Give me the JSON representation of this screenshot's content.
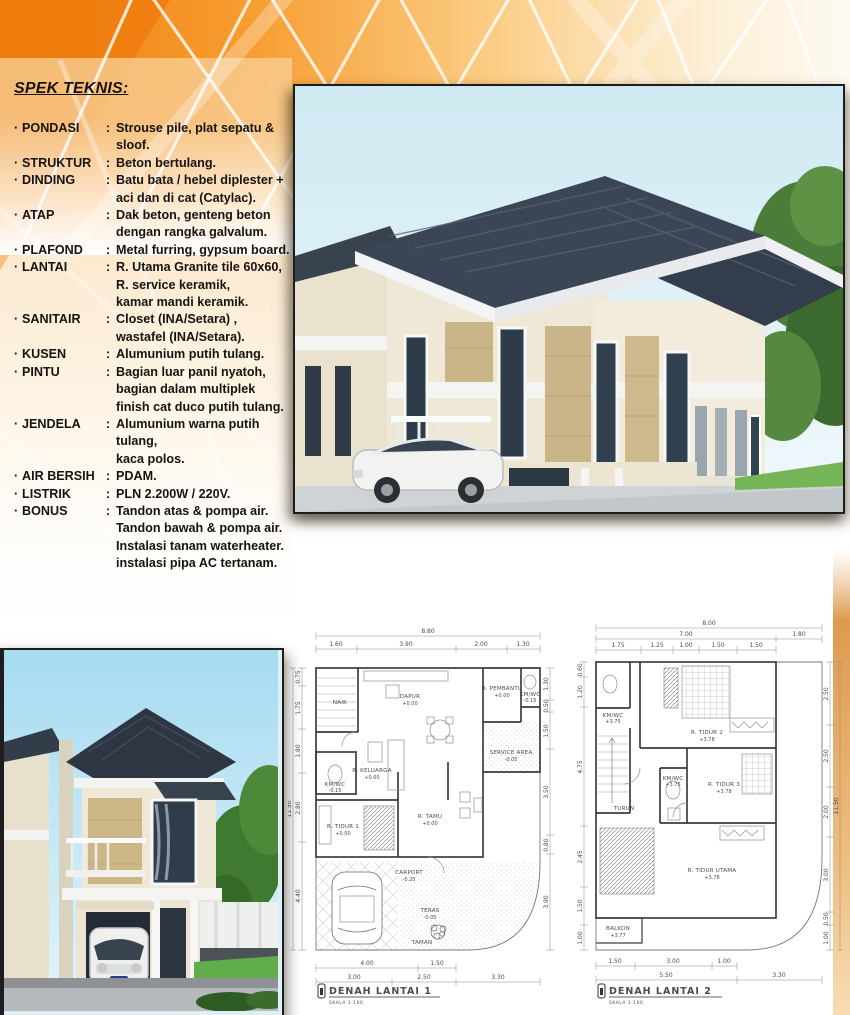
{
  "spec": {
    "title": "SPEK TEKNIS:",
    "bullet": "·",
    "colon": ":",
    "items": [
      {
        "label": "PONDASI",
        "value": "Strouse pile, plat sepatu &\nsloof."
      },
      {
        "label": "STRUKTUR",
        "value": "Beton bertulang."
      },
      {
        "label": "DINDING",
        "value": "Batu bata / hebel diplester +\naci dan di cat (Catylac)."
      },
      {
        "label": "ATAP",
        "value": "Dak beton, genteng beton\ndengan rangka galvalum."
      },
      {
        "label": "PLAFOND",
        "value": "Metal furring, gypsum board."
      },
      {
        "label": "LANTAI",
        "value": "R. Utama Granite tile 60x60,\nR. service keramik,\nkamar mandi keramik."
      },
      {
        "label": "SANITAIR",
        "value": "Closet (INA/Setara) ,\nwastafel (INA/Setara)."
      },
      {
        "label": "KUSEN",
        "value": "Alumunium putih tulang."
      },
      {
        "label": "PINTU",
        "value": "Bagian luar panil nyatoh,\nbagian dalam multiplek\nfinish cat duco putih tulang."
      },
      {
        "label": "JENDELA",
        "value": "Alumunium warna putih tulang,\nkaca polos."
      },
      {
        "label": "AIR BERSIH",
        "value": "PDAM."
      },
      {
        "label": "LISTRIK",
        "value": "PLN 2.200W / 220V."
      },
      {
        "label": "BONUS",
        "value": "Tandon atas & pompa air.\nTandon bawah & pompa air.\nInstalasi tanam waterheater.\ninstalasi pipa AC tertanam."
      }
    ]
  },
  "plan1": {
    "title": "DENAH LANTAI 1",
    "scale": "SKALA 1:100",
    "rooms": [
      {
        "name": "NAIK",
        "elev": ""
      },
      {
        "name": "DAPUR",
        "elev": "+0.00"
      },
      {
        "name": "R. PEMBANTU",
        "elev": "+0.00"
      },
      {
        "name": "KM/WC",
        "elev": "-0.15"
      },
      {
        "name": "SERVICE AREA",
        "elev": "-0.05"
      },
      {
        "name": "R. KELUARGA",
        "elev": "+0.00"
      },
      {
        "name": "KM/WC",
        "elev": "-0.15"
      },
      {
        "name": "R. TIDUR 1",
        "elev": "+0.00"
      },
      {
        "name": "R. TAMU",
        "elev": "+0.00"
      },
      {
        "name": "CARPORT",
        "elev": "-0.20"
      },
      {
        "name": "TERAS",
        "elev": "-0.05"
      },
      {
        "name": "TAMAN",
        "elev": ""
      }
    ],
    "dims": {
      "total_top": "8.80",
      "top": [
        "1.60",
        "3.90",
        "2.00",
        "1.30"
      ],
      "bottom_row1": [
        "4.00",
        "1.50"
      ],
      "bottom_row2": [
        "3.00",
        "2.50",
        "3.30"
      ],
      "left": [
        "0.75",
        "1.75",
        "1.80",
        "2.80",
        "4.40"
      ],
      "left_total": "11.50",
      "right": [
        "1.30",
        "0.50",
        "1.50",
        "3.50",
        "0.80",
        "3.90"
      ]
    }
  },
  "plan2": {
    "title": "DENAH LANTAI 2",
    "scale": "SKALA 1:100",
    "rooms": [
      {
        "name": "KM/WC",
        "elev": "+3.75"
      },
      {
        "name": "R. TIDUR 2",
        "elev": "+3.78"
      },
      {
        "name": "R. TIDUR 3",
        "elev": "+3.78"
      },
      {
        "name": "TURUN",
        "elev": ""
      },
      {
        "name": "KM/WC",
        "elev": "+3.75"
      },
      {
        "name": "BALKON",
        "elev": "+3.77"
      },
      {
        "name": "R. TIDUR UTAMA",
        "elev": "+3.78"
      }
    ],
    "dims": {
      "total_top": "8.00",
      "top_row2": [
        "7.00",
        "1.80"
      ],
      "top": [
        "1.75",
        "1.25",
        "1.00",
        "1.50",
        "1.50"
      ],
      "bottom_row1": [
        "1.50",
        "3.00",
        "1.00"
      ],
      "bottom_row2": [
        "5.50",
        "3.30"
      ],
      "left": [
        "0.60",
        "1.20",
        "4.75",
        "2.45",
        "1.50",
        "1.00"
      ],
      "right": [
        "2.50",
        "2.50",
        "2.00",
        "3.00",
        "0.50",
        "1.00"
      ],
      "right_total": "11.50"
    }
  },
  "colors": {
    "accent_orange": "#f08a1d",
    "deep_orange": "#ee7d0e",
    "roof_slate": "#343d4b",
    "wall_cream": "#f0e9d8",
    "stone_tan": "#c9b587",
    "sky_blue": "#bfe4f2"
  }
}
